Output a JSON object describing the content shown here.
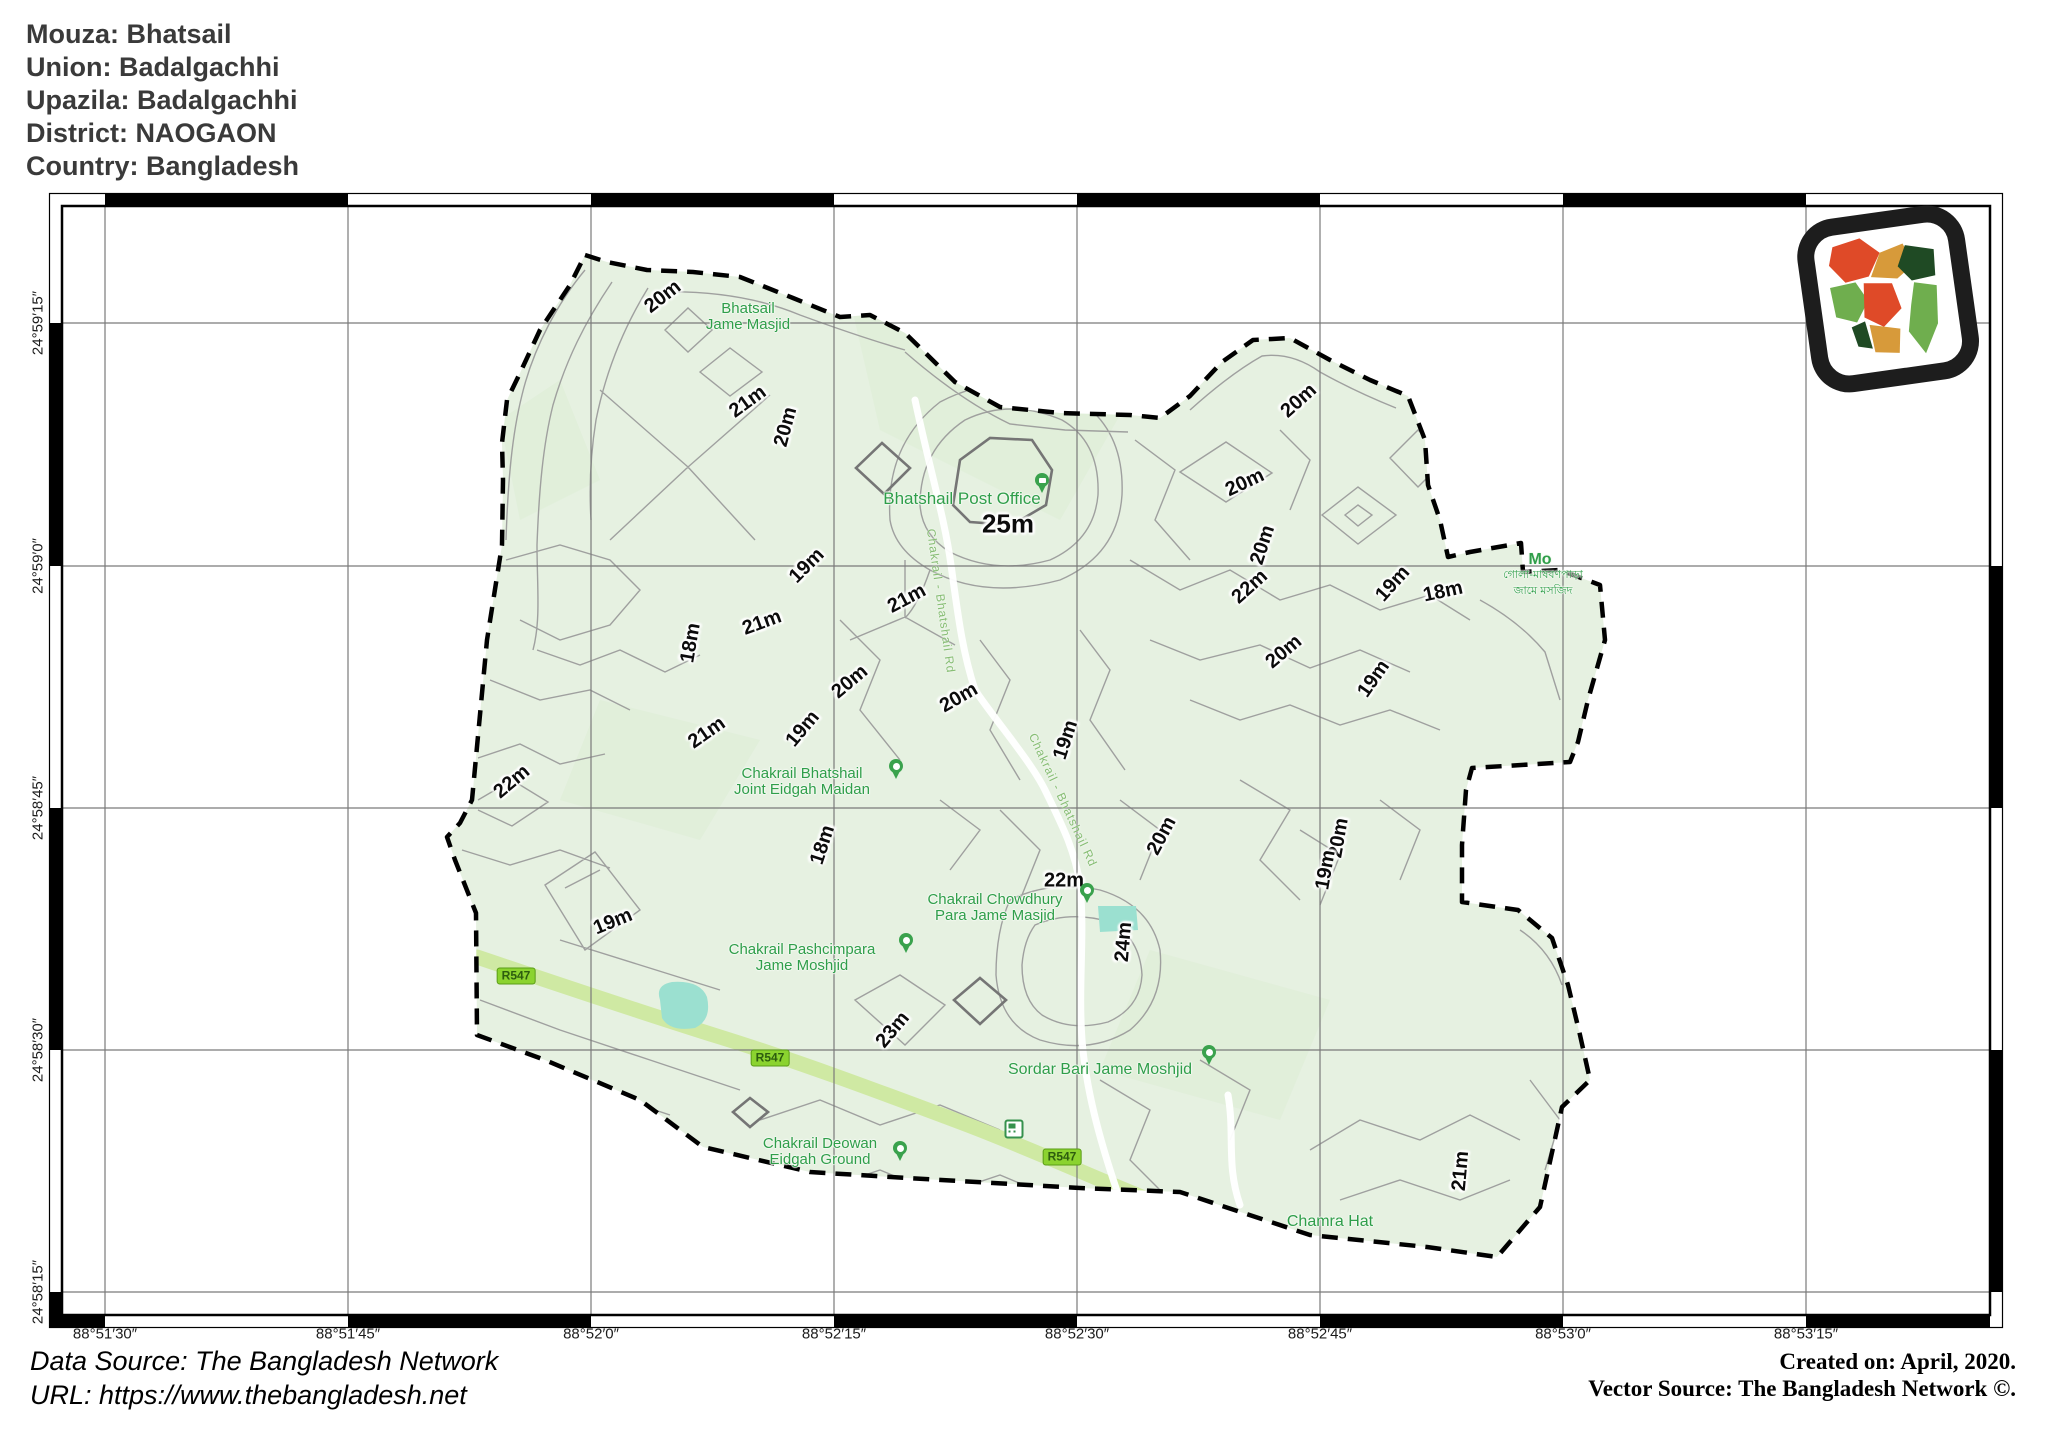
{
  "header": {
    "lines": [
      "Mouza: Bhatsail",
      "Union: Badalgachhi",
      "Upazila: Badalgachhi",
      "District: NAOGAON",
      "Country: Bangladesh"
    ]
  },
  "footer": {
    "data_source": "Data Source: The Bangladesh Network",
    "url": "URL: https://www.thebangladesh.net",
    "created": "Created on: April, 2020.",
    "vector_source": "Vector Source: The Bangladesh Network ©."
  },
  "colors": {
    "map_fill": "#e6f1e1",
    "contour": "#9b9b9b",
    "contour_bold": "#757575",
    "boundary": "#000000",
    "water": "#9be0d0",
    "road_major": "#cfe9a3",
    "road_minor": "#ffffff",
    "place_label": "#2f9e4a",
    "road_label": "#86bd73",
    "badge_bg": "#8bd32f",
    "badge_border": "#5a9c17",
    "badge_text": "#2d5d0e",
    "pin_green": "#3aa24d"
  },
  "map": {
    "axis": {
      "lon": [
        {
          "label": "88°51′30″",
          "x": 105
        },
        {
          "label": "88°51′45″",
          "x": 348
        },
        {
          "label": "88°52′0″",
          "x": 591
        },
        {
          "label": "88°52′15″",
          "x": 834
        },
        {
          "label": "88°52′30″",
          "x": 1077
        },
        {
          "label": "88°52′45″",
          "x": 1320
        },
        {
          "label": "88°53′0″",
          "x": 1563
        },
        {
          "label": "88°53′15″",
          "x": 1806
        }
      ],
      "lat": [
        {
          "label": "24°59′15″",
          "y": 323
        },
        {
          "label": "24°59′0″",
          "y": 566
        },
        {
          "label": "24°58′45″",
          "y": 808
        },
        {
          "label": "24°58′30″",
          "y": 1050
        },
        {
          "label": "24°58′15″",
          "y": 1292
        }
      ]
    },
    "contour_labels": [
      {
        "text": "20m",
        "x": 663,
        "y": 297,
        "rot": -38
      },
      {
        "text": "21m",
        "x": 748,
        "y": 402,
        "rot": -36
      },
      {
        "text": "20m",
        "x": 786,
        "y": 427,
        "rot": -75
      },
      {
        "text": "20m",
        "x": 1299,
        "y": 401,
        "rot": -42
      },
      {
        "text": "20m",
        "x": 1245,
        "y": 483,
        "rot": -25
      },
      {
        "text": "25m",
        "x": 1008,
        "y": 524,
        "rot": 0,
        "size": 26
      },
      {
        "text": "20m",
        "x": 1263,
        "y": 545,
        "rot": -72
      },
      {
        "text": "22m",
        "x": 1250,
        "y": 587,
        "rot": -42
      },
      {
        "text": "19m",
        "x": 1393,
        "y": 584,
        "rot": -48
      },
      {
        "text": "18m",
        "x": 1443,
        "y": 592,
        "rot": -12
      },
      {
        "text": "19m",
        "x": 807,
        "y": 566,
        "rot": -45
      },
      {
        "text": "21m",
        "x": 907,
        "y": 599,
        "rot": -28
      },
      {
        "text": "18m",
        "x": 691,
        "y": 643,
        "rot": -80
      },
      {
        "text": "21m",
        "x": 762,
        "y": 623,
        "rot": -20
      },
      {
        "text": "20m",
        "x": 850,
        "y": 682,
        "rot": -40
      },
      {
        "text": "20m",
        "x": 959,
        "y": 698,
        "rot": -30
      },
      {
        "text": "19m",
        "x": 1066,
        "y": 740,
        "rot": -72
      },
      {
        "text": "20m",
        "x": 1284,
        "y": 652,
        "rot": -40
      },
      {
        "text": "19m",
        "x": 1374,
        "y": 679,
        "rot": -55
      },
      {
        "text": "21m",
        "x": 707,
        "y": 733,
        "rot": -35
      },
      {
        "text": "19m",
        "x": 803,
        "y": 729,
        "rot": -50
      },
      {
        "text": "22m",
        "x": 512,
        "y": 782,
        "rot": -40
      },
      {
        "text": "18m",
        "x": 823,
        "y": 845,
        "rot": -72
      },
      {
        "text": "20m",
        "x": 1162,
        "y": 836,
        "rot": -62
      },
      {
        "text": "20m",
        "x": 1339,
        "y": 838,
        "rot": -80
      },
      {
        "text": "19m",
        "x": 1326,
        "y": 870,
        "rot": -80
      },
      {
        "text": "22m",
        "x": 1064,
        "y": 881,
        "rot": 0
      },
      {
        "text": "24m",
        "x": 1124,
        "y": 942,
        "rot": -85
      },
      {
        "text": "19m",
        "x": 613,
        "y": 922,
        "rot": -22
      },
      {
        "text": "23m",
        "x": 893,
        "y": 1030,
        "rot": -50
      },
      {
        "text": "21m",
        "x": 1461,
        "y": 1171,
        "rot": -85
      }
    ],
    "places": [
      {
        "lines": [
          "Bhatsail",
          "Jame Masjid"
        ],
        "x": 748,
        "y": 317
      },
      {
        "lines": [
          "Bhatshail Post Office"
        ],
        "x": 962,
        "y": 499,
        "size": 17,
        "pin": "post",
        "pin_x": 1042,
        "pin_y": 494
      },
      {
        "lines": [
          "Chakrail Bhatshail",
          "Joint Eidgah Maidan"
        ],
        "x": 802,
        "y": 782,
        "pin": "mosque",
        "pin_x": 896,
        "pin_y": 780
      },
      {
        "lines": [
          "Chakrail Chowdhury",
          "Para Jame Masjid"
        ],
        "x": 995,
        "y": 908,
        "pin": "mosque",
        "pin_x": 1087,
        "pin_y": 904
      },
      {
        "lines": [
          "Chakrail Pashcimpara",
          "Jame Moshjid"
        ],
        "x": 802,
        "y": 958,
        "pin": "mosque",
        "pin_x": 906,
        "pin_y": 954
      },
      {
        "lines": [
          "Sordar Bari Jame Moshjid"
        ],
        "x": 1100,
        "y": 1070,
        "size": 16,
        "pin": "mosque",
        "pin_x": 1209,
        "pin_y": 1066
      },
      {
        "lines": [
          "Chakrail Deowan",
          "Eidgah Ground"
        ],
        "x": 820,
        "y": 1152,
        "pin": "mosque",
        "pin_x": 900,
        "pin_y": 1162
      },
      {
        "lines": [
          "Chamra Hat"
        ],
        "x": 1330,
        "y": 1222,
        "size": 16
      },
      {
        "lines": [
          "Mo"
        ],
        "x": 1540,
        "y": 560,
        "size": 16,
        "bold": true
      },
      {
        "lines": [
          "গোলা-মাষবণপাড়া",
          "জামে মসজিদ"
        ],
        "x": 1543,
        "y": 583,
        "size": 11
      }
    ],
    "road_labels": [
      {
        "text": "Chakrail - Bhatshail Rd",
        "x": 941,
        "y": 601,
        "rot": 82
      },
      {
        "text": "Chakrail - Bhatshail Rd",
        "x": 1063,
        "y": 800,
        "rot": 65
      }
    ],
    "road_badges": [
      {
        "text": "R547",
        "x": 516,
        "y": 976
      },
      {
        "text": "R547",
        "x": 770,
        "y": 1058
      },
      {
        "text": "R547",
        "x": 1062,
        "y": 1157
      }
    ],
    "icons": {
      "transit": {
        "x": 1022,
        "y": 1137
      }
    },
    "logo": {
      "name": "bangladesh-map-logo"
    }
  }
}
